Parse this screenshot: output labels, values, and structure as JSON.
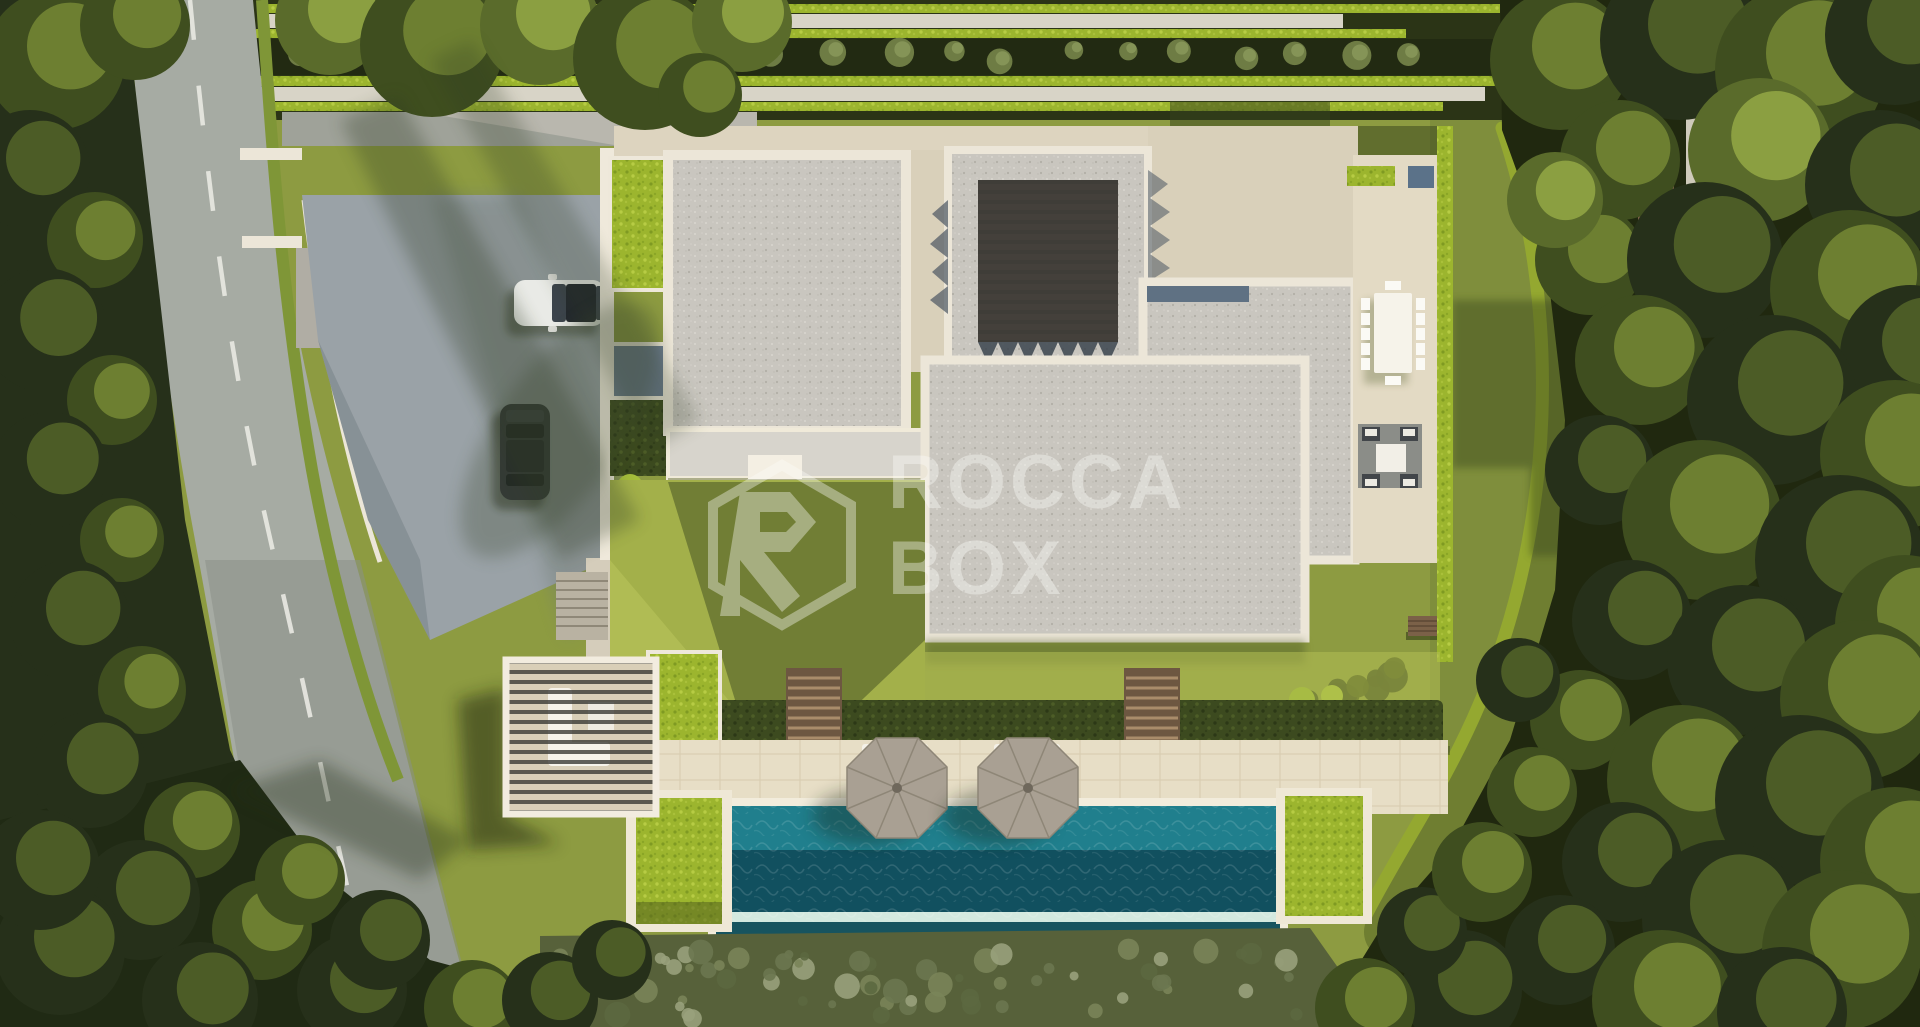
{
  "watermark": {
    "line1": "ROCCA",
    "line2": "BOX",
    "logo": "hexagon-r-monogram",
    "opacity": 0.38
  },
  "scene": {
    "type": "aerial-architectural-render",
    "view": "top-down",
    "subject": "Modern luxury villa with gravel flat roofs, central pergola, landscaped lawns, infinity pool with two parasols, driveway with two parked cars, hedgerow terraces and surrounding woodland with a curving road",
    "counts": {
      "parasols": 2,
      "cars": 2,
      "pools": 1,
      "hedge_stair_cuts": 2
    }
  },
  "palette": {
    "forest_dark": "#26301a",
    "canopy_mid": "#3f4e1f",
    "canopy_olive": "#5a6b2b",
    "canopy_light": "#7d9038",
    "canopy_sunlit": "#9cb04a",
    "lawn": "#8d9b41",
    "lawn_bright": "#a9b64d",
    "lawn_shadow": "#46531f",
    "hedge_bright": "#9cb52e",
    "hedge_dark": "#3c4a1f",
    "road_asphalt": "#a6aba3",
    "road_line": "#e9e9e2",
    "driveway": "#9aa2a7",
    "roof_gravel": "#c9c6bf",
    "roof_trim": "#ece6d8",
    "stone_court": "#d9d0ba",
    "deck_pavers": "#e7dec6",
    "pool_shallow": "#207f8d",
    "pool_deep": "#11505f",
    "pool_edge_foam": "#cfe9df",
    "umbrella": "#a9a093",
    "wood": "#7b6148",
    "glass": "#5f7183",
    "car_white": "#e9eae6",
    "car_dark": "#33373a",
    "watermark_white": "#fdfdfa"
  }
}
